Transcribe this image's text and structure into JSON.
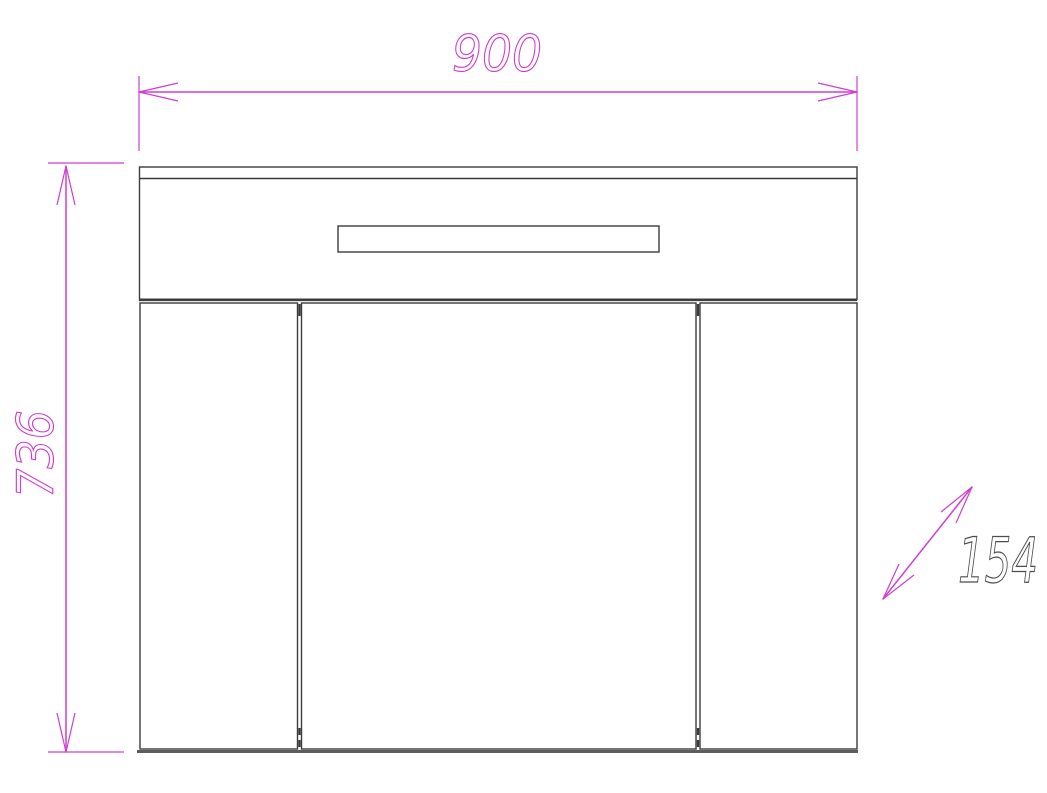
{
  "dims": {
    "width": "900",
    "height": "736",
    "depth": "154"
  },
  "colors": {
    "bg": "#ffffff",
    "dim": "#cf3ecf",
    "depth_text": "#4d4d4d",
    "line": "#3c3c3c",
    "line_mid": "#5d5d5d",
    "hatch": "#333333"
  }
}
